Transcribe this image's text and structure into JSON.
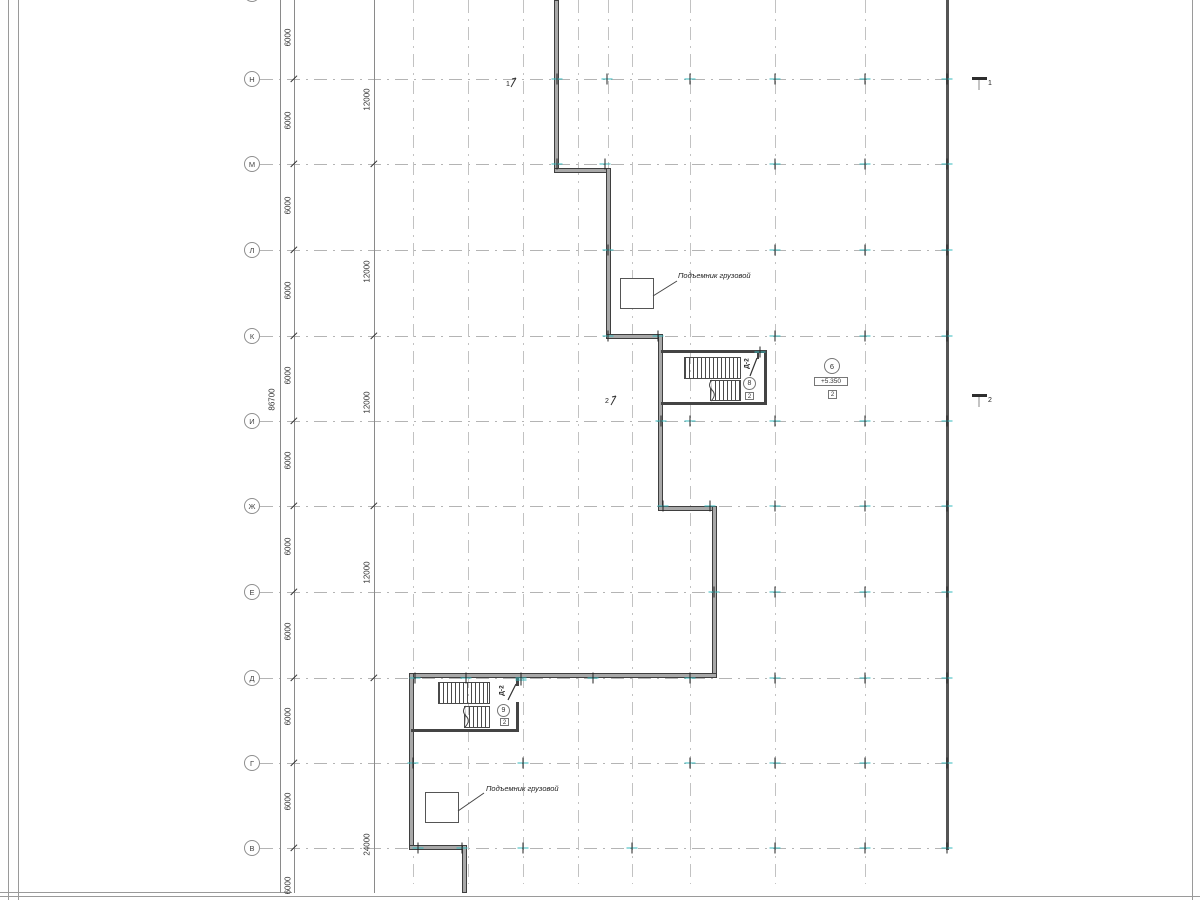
{
  "drawing": {
    "annotations": {
      "lift_upper": "Подъемник грузовой",
      "lift_lower": "Подъемник грузовой"
    },
    "stair_upper": {
      "door_label": "Д-2",
      "room_circle": "8",
      "room_box": "2"
    },
    "stair_lower": {
      "door_label": "Д-2",
      "room_circle": "9",
      "room_box": "2"
    },
    "level_marker": {
      "circle": "6",
      "elevation": "+5.350",
      "box": "2"
    },
    "section_marks": {
      "left_1": "1",
      "left_2": "2",
      "right_1": "1",
      "right_2": "2"
    },
    "dimensions": {
      "total": {
        "text": "86700",
        "x": 272,
        "y": 400
      },
      "col_6000": {
        "line_x": 294,
        "text_x": 288,
        "labels": [
          {
            "text": "6000",
            "y": 38
          },
          {
            "text": "6000",
            "y": 121
          },
          {
            "text": "6000",
            "y": 206
          },
          {
            "text": "6000",
            "y": 291
          },
          {
            "text": "6000",
            "y": 376
          },
          {
            "text": "6000",
            "y": 461
          },
          {
            "text": "6000",
            "y": 547
          },
          {
            "text": "6000",
            "y": 632
          },
          {
            "text": "6000",
            "y": 717
          },
          {
            "text": "6000",
            "y": 802
          },
          {
            "text": "6000",
            "y": 886
          }
        ],
        "tick_ys": [
          79,
          164,
          250,
          336,
          421,
          506,
          592,
          678,
          763,
          848
        ]
      },
      "col_12000": {
        "line_x": 374,
        "text_x": 367,
        "labels": [
          {
            "text": "12000",
            "y": 100
          },
          {
            "text": "12000",
            "y": 272
          },
          {
            "text": "12000",
            "y": 403
          },
          {
            "text": "12000",
            "y": 573
          },
          {
            "text": "24000",
            "y": 845
          }
        ],
        "tick_ys": [
          164,
          336,
          506,
          678
        ]
      },
      "total_line_x": 280
    },
    "axes_rows": [
      {
        "label": "Н",
        "y": 79
      },
      {
        "label": "М",
        "y": 164
      },
      {
        "label": "Л",
        "y": 250
      },
      {
        "label": "К",
        "y": 336
      },
      {
        "label": "И",
        "y": 421
      },
      {
        "label": "Ж",
        "y": 506
      },
      {
        "label": "Е",
        "y": 592
      },
      {
        "label": "Д",
        "y": 678
      },
      {
        "label": "Г",
        "y": 763
      },
      {
        "label": "В",
        "y": 848
      }
    ],
    "axis_line": {
      "x1": 260,
      "x2": 950
    },
    "bubble_x": 244,
    "top_partial_bubble": {
      "x": 244,
      "y": -14
    },
    "grid_columns": [
      {
        "x": 413,
        "y1": 0,
        "y2": 884
      },
      {
        "x": 468,
        "y1": 0,
        "y2": 884
      },
      {
        "x": 523,
        "y1": 0,
        "y2": 884
      },
      {
        "x": 578,
        "y1": 0,
        "y2": 884
      },
      {
        "x": 632,
        "y1": 0,
        "y2": 884
      },
      {
        "x": 690,
        "y1": 0,
        "y2": 884
      },
      {
        "x": 775,
        "y1": 0,
        "y2": 884
      },
      {
        "x": 865,
        "y1": 0,
        "y2": 884
      },
      {
        "x": 608,
        "y1": 0,
        "y2": 168
      }
    ],
    "walls": [
      {
        "x": 554,
        "y": 0,
        "w": 5,
        "h": 173
      },
      {
        "x": 554,
        "y": 168,
        "w": 57,
        "h": 5
      },
      {
        "x": 606,
        "y": 168,
        "w": 5,
        "h": 171
      },
      {
        "x": 606,
        "y": 334,
        "w": 57,
        "h": 5
      },
      {
        "x": 658,
        "y": 334,
        "w": 5,
        "h": 177
      },
      {
        "x": 658,
        "y": 506,
        "w": 59,
        "h": 5
      },
      {
        "x": 712,
        "y": 506,
        "w": 5,
        "h": 172
      },
      {
        "x": 409,
        "y": 673,
        "w": 308,
        "h": 5
      },
      {
        "x": 409,
        "y": 673,
        "w": 5,
        "h": 177
      },
      {
        "x": 409,
        "y": 845,
        "w": 57,
        "h": 5
      },
      {
        "x": 462,
        "y": 845,
        "w": 5,
        "h": 48
      }
    ],
    "right_wall": {
      "x": 946,
      "y": 0,
      "w": 3,
      "h": 850
    },
    "thin_walls": [
      {
        "x": 661,
        "y": 350,
        "w": 106,
        "h": 3
      },
      {
        "x": 764,
        "y": 350,
        "w": 3,
        "h": 55
      },
      {
        "x": 661,
        "y": 402,
        "w": 106,
        "h": 3
      },
      {
        "x": 757,
        "y": 353,
        "w": 2,
        "h": 6
      },
      {
        "x": 411,
        "y": 729,
        "w": 108,
        "h": 3
      },
      {
        "x": 516,
        "y": 702,
        "w": 3,
        "h": 30
      },
      {
        "x": 516,
        "y": 678,
        "w": 3,
        "h": 8
      }
    ],
    "flights": [
      {
        "x": 684,
        "y": 357,
        "w": 57,
        "h": 22
      },
      {
        "x": 710,
        "y": 380,
        "w": 31,
        "h": 21
      },
      {
        "x": 438,
        "y": 682,
        "w": 52,
        "h": 22
      },
      {
        "x": 464,
        "y": 706,
        "w": 26,
        "h": 22
      }
    ],
    "lift_boxes": [
      {
        "x": 620,
        "y": 278,
        "w": 34,
        "h": 31
      },
      {
        "x": 425,
        "y": 792,
        "w": 34,
        "h": 31
      }
    ],
    "column_ticks": [
      [
        557,
        79
      ],
      [
        607,
        79
      ],
      [
        690,
        79
      ],
      [
        775,
        79
      ],
      [
        865,
        79
      ],
      [
        947,
        79
      ],
      [
        557,
        164
      ],
      [
        605,
        164
      ],
      [
        775,
        164
      ],
      [
        865,
        164
      ],
      [
        947,
        164
      ],
      [
        608,
        250
      ],
      [
        775,
        250
      ],
      [
        865,
        250
      ],
      [
        947,
        250
      ],
      [
        608,
        336
      ],
      [
        658,
        336
      ],
      [
        775,
        336
      ],
      [
        865,
        336
      ],
      [
        947,
        336
      ],
      [
        661,
        421
      ],
      [
        690,
        421
      ],
      [
        775,
        421
      ],
      [
        865,
        421
      ],
      [
        947,
        421
      ],
      [
        663,
        506
      ],
      [
        710,
        506
      ],
      [
        775,
        506
      ],
      [
        865,
        506
      ],
      [
        947,
        506
      ],
      [
        714,
        592
      ],
      [
        775,
        592
      ],
      [
        865,
        592
      ],
      [
        947,
        592
      ],
      [
        415,
        678
      ],
      [
        466,
        678
      ],
      [
        521,
        678
      ],
      [
        593,
        678
      ],
      [
        690,
        678
      ],
      [
        775,
        678
      ],
      [
        865,
        678
      ],
      [
        947,
        678
      ],
      [
        413,
        763
      ],
      [
        523,
        763
      ],
      [
        690,
        763
      ],
      [
        775,
        763
      ],
      [
        865,
        763
      ],
      [
        947,
        763
      ],
      [
        418,
        848
      ],
      [
        462,
        848
      ],
      [
        523,
        848
      ],
      [
        632,
        848
      ],
      [
        775,
        848
      ],
      [
        865,
        848
      ],
      [
        947,
        848
      ],
      [
        521,
        680
      ],
      [
        760,
        352
      ]
    ],
    "colors": {
      "grid": "#b4b4b4",
      "wall_edge": "#3f3f3f",
      "wall_fill": "#a8a8a8",
      "tick_cyan": "#35b8bc",
      "dim_line": "#8a8a8a",
      "text": "#333333"
    }
  }
}
